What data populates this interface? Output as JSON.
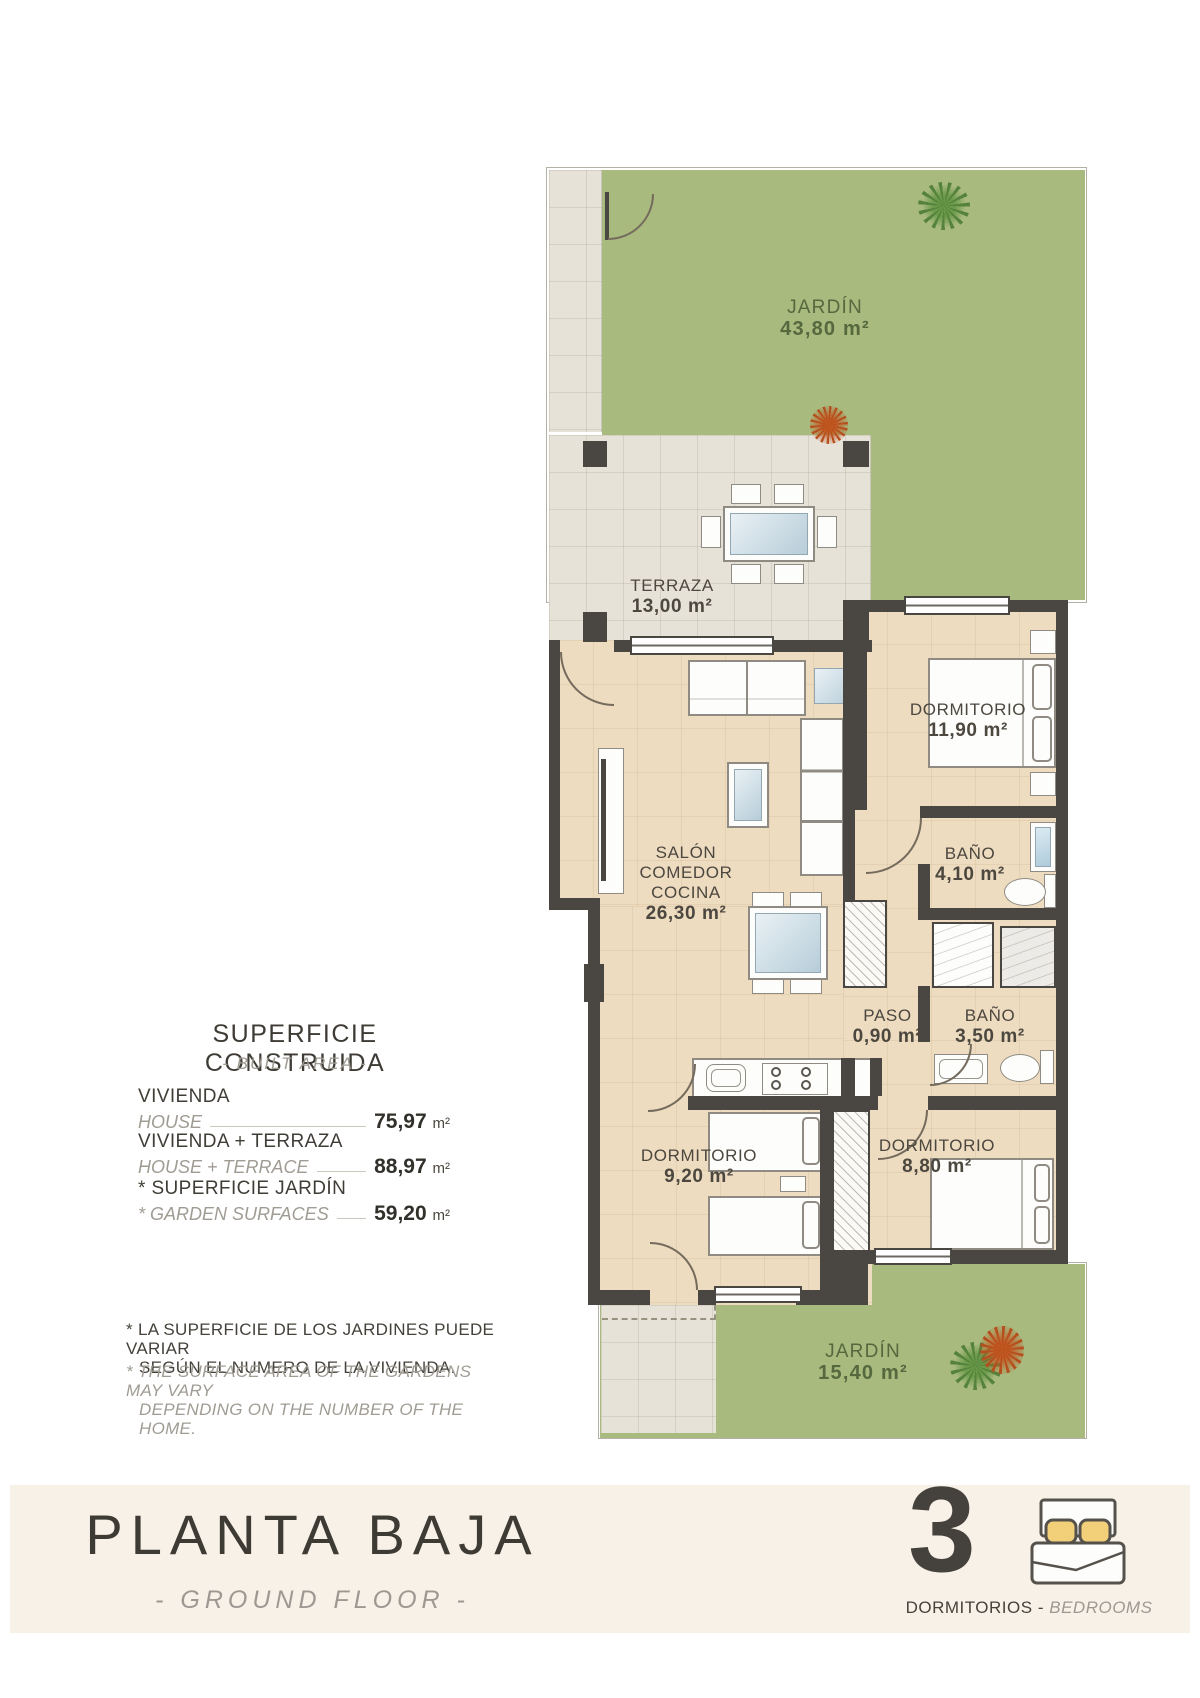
{
  "plan": {
    "rooms": {
      "jardin_top": {
        "name": "JARDÍN",
        "area": "43,80 m²"
      },
      "terraza": {
        "name": "TERRAZA",
        "area": "13,00 m²"
      },
      "salon": {
        "name_line1": "SALÓN",
        "name_line2": "COMEDOR",
        "name_line3": "COCINA",
        "area": "26,30 m²"
      },
      "dormitorio_1": {
        "name": "DORMITORIO",
        "area": "11,90 m²"
      },
      "bano_1": {
        "name": "BAÑO",
        "area": "4,10 m²"
      },
      "paso": {
        "name": "PASO",
        "area": "0,90 m²"
      },
      "bano_2": {
        "name": "BAÑO",
        "area": "3,50 m²"
      },
      "dormitorio_2": {
        "name": "DORMITORIO",
        "area": "9,20 m²"
      },
      "dormitorio_3": {
        "name": "DORMITORIO",
        "area": "8,80 m²"
      },
      "jardin_bottom": {
        "name": "JARDÍN",
        "area": "15,40 m²"
      }
    },
    "colors": {
      "garden": "#a8ba7e",
      "wall": "#4a4641",
      "floor": "#eedcc1",
      "tile": "#e7e2d8",
      "garden_text": "#55683e",
      "label_text": "#4c473f",
      "footer_band": "#f8f1e7",
      "pillow_yellow": "#f2cf79"
    }
  },
  "info_panel": {
    "title": "SUPERFICIE CONSTRUIDA",
    "subtitle": "- BUILT AREA -",
    "rows": [
      {
        "label_es": "VIVIENDA",
        "label_en": "HOUSE",
        "value": "75,97",
        "unit": "m²"
      },
      {
        "label_es": "VIVIENDA + TERRAZA",
        "label_en": "HOUSE + TERRACE",
        "value": "88,97",
        "unit": "m²"
      },
      {
        "label_es": "* SUPERFICIE JARDÍN",
        "label_en": "* GARDEN SURFACES",
        "value": "59,20",
        "unit": "m²"
      }
    ],
    "footnote": {
      "es_line1": "* LA SUPERFICIE DE LOS JARDINES PUEDE VARIAR",
      "es_line2": "SEGÚN EL NUMERO DE LA VIVIENDA.",
      "en_line1": "* THE SURFACE AREA OF THE GARDENS MAY VARY",
      "en_line2": "DEPENDING ON THE NUMBER OF THE HOME."
    }
  },
  "footer": {
    "title": "PLANTA BAJA",
    "subtitle": "- GROUND FLOOR -",
    "bedrooms": {
      "count": "3",
      "label_es": "DORMITORIOS",
      "sep": "-",
      "label_en": "BEDROOMS"
    }
  }
}
